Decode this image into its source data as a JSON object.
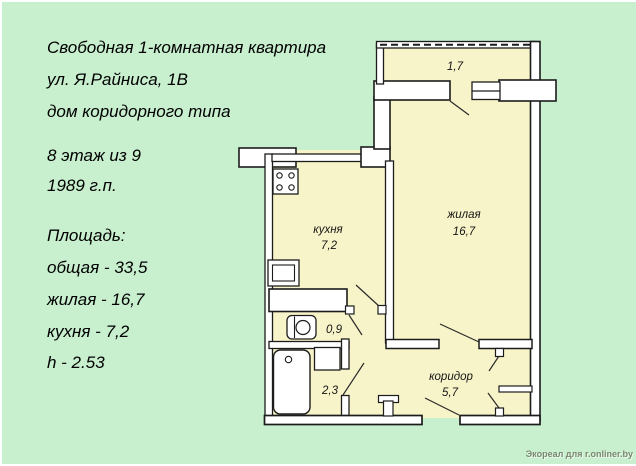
{
  "listing": {
    "title": "Свободная 1-комнатная квартира",
    "address": "ул. Я.Райниса, 1В",
    "building_type": "дом коридорного типа",
    "floor": "8 этаж из 9",
    "year_built": "1989 г.п.",
    "area_header": "Площадь:",
    "area_total": "общая - 33,5",
    "area_living": "жилая - 16,7",
    "area_kitchen": "кухня - 7,2",
    "ceiling_height": "h - 2.53"
  },
  "floorplan": {
    "labels": {
      "balcony_area": "1,7",
      "kitchen_name": "кухня",
      "kitchen_area": "7,2",
      "living_name": "жилая",
      "living_area": "16,7",
      "wc_area": "0,9",
      "bath_area": "2,3",
      "corridor_name": "коридор",
      "corridor_area": "5,7"
    },
    "colors": {
      "background": "#c8efce",
      "room_fill": "#f8f4c9",
      "wall_fill": "#ffffff",
      "outline": "#1c1c1c"
    }
  },
  "watermark": "Экореал для r.onliner.by"
}
